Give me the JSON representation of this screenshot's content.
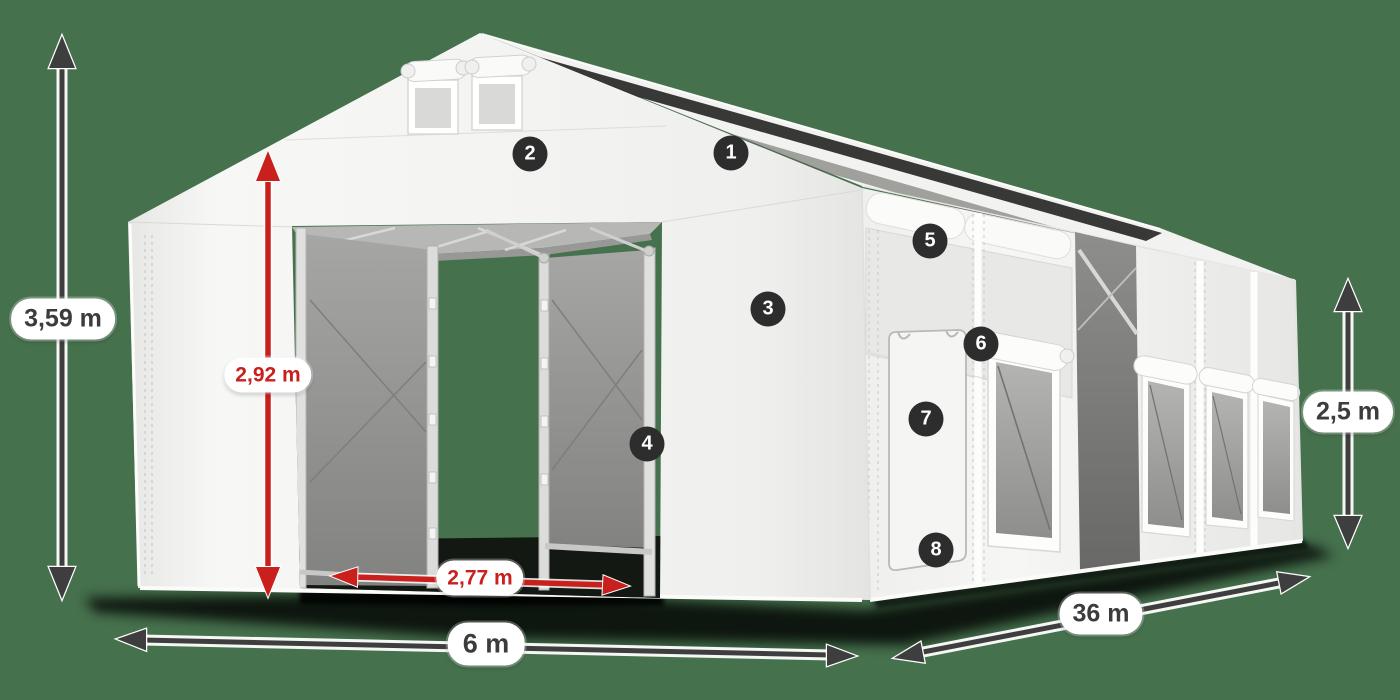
{
  "diagram": {
    "subject": "storage-tent-dimension-diagram",
    "view": "perspective-front-left"
  },
  "dimensions": {
    "total_height": "3,59 m",
    "entrance_height": "2,92 m",
    "entrance_width": "2,77 m",
    "width": "6 m",
    "length": "36 m",
    "side_wall_height": "2,5 m"
  },
  "callouts": [
    {
      "number": "1"
    },
    {
      "number": "2"
    },
    {
      "number": "3"
    },
    {
      "number": "4"
    },
    {
      "number": "5"
    },
    {
      "number": "6"
    },
    {
      "number": "7"
    },
    {
      "number": "8"
    }
  ],
  "colors": {
    "background": "#46714d",
    "tent_fabric": "#f4f4f2",
    "mesh_gray": "#9c9c9a",
    "dimension_red": "#c9201d",
    "dimension_dark": "#3e3e3e",
    "label_pill_bg": "#ffffff",
    "badge_bg": "#2d2d2d",
    "badge_text": "#ffffff",
    "shadow": "#000000"
  }
}
